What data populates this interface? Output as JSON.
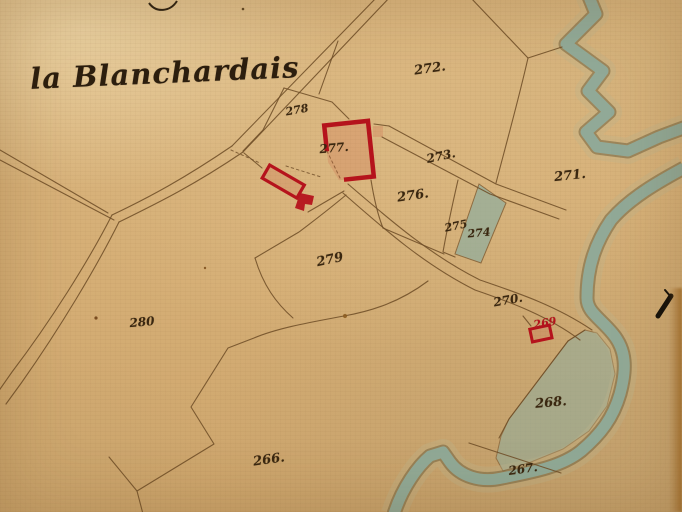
{
  "map_title": {
    "text": "la Blanchardais"
  },
  "parcels": [
    {
      "number": "272.",
      "x": 430,
      "y": 69,
      "rot": -8,
      "size": 13
    },
    {
      "number": "278",
      "x": 297,
      "y": 110,
      "rot": -10,
      "size": 11
    },
    {
      "number": "277.",
      "x": 334,
      "y": 148,
      "rot": -5,
      "size": 12
    },
    {
      "number": "273.",
      "x": 441,
      "y": 156,
      "rot": -12,
      "size": 12
    },
    {
      "number": "271.",
      "x": 570,
      "y": 176,
      "rot": -6,
      "size": 13
    },
    {
      "number": "276.",
      "x": 413,
      "y": 196,
      "rot": -8,
      "size": 13
    },
    {
      "number": "275",
      "x": 456,
      "y": 226,
      "rot": -12,
      "size": 11
    },
    {
      "number": "274",
      "x": 479,
      "y": 233,
      "rot": -5,
      "size": 11
    },
    {
      "number": "279",
      "x": 330,
      "y": 260,
      "rot": -12,
      "size": 13
    },
    {
      "number": "270.",
      "x": 508,
      "y": 300,
      "rot": -10,
      "size": 12
    },
    {
      "number": "269",
      "x": 545,
      "y": 323,
      "rot": -10,
      "size": 11,
      "color": "red"
    },
    {
      "number": "280",
      "x": 142,
      "y": 322,
      "rot": -5,
      "size": 12
    },
    {
      "number": "268.",
      "x": 551,
      "y": 403,
      "rot": -5,
      "size": 13
    },
    {
      "number": "266.",
      "x": 269,
      "y": 460,
      "rot": -8,
      "size": 13
    },
    {
      "number": "267.",
      "x": 523,
      "y": 469,
      "rot": -8,
      "size": 12
    }
  ],
  "colors": {
    "ink": "#6f4e28",
    "label_ink": "#3a2710",
    "building_red": "#b5131c",
    "water": "#8fae9f",
    "paper": "#d5ae75"
  },
  "annotations": {
    "pen_mark": "black pen stroke",
    "top_edge_writing": "cut-off handwriting stroke"
  }
}
